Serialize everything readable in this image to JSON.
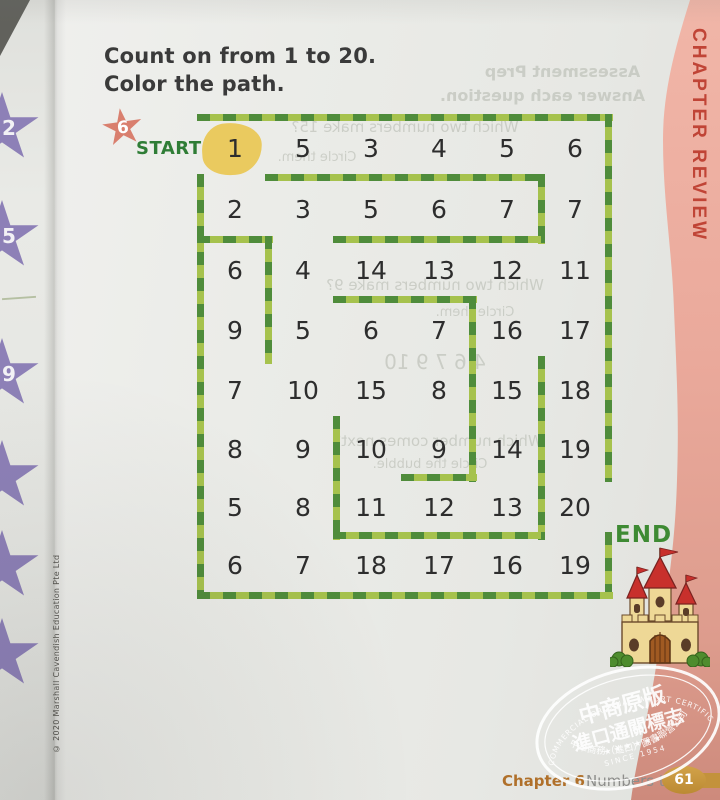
{
  "page": {
    "title_line1": "Count on from 1 to 20.",
    "title_line2": "Color the path.",
    "chapter_tab": "CHAPTER REVIEW",
    "copyright": "© 2020 Marshall Cavendish Education Pte Ltd",
    "footer": {
      "chapter": "Chapter 6",
      "section": "Numbers to 20",
      "page_number": "61"
    }
  },
  "maze": {
    "start_badge": "6",
    "start_label": "START",
    "end_label": "END",
    "grid": [
      [
        "1",
        "5",
        "3",
        "4",
        "5",
        "6"
      ],
      [
        "2",
        "3",
        "5",
        "6",
        "7",
        "7"
      ],
      [
        "6",
        "4",
        "14",
        "13",
        "12",
        "11"
      ],
      [
        "9",
        "5",
        "6",
        "7",
        "16",
        "17"
      ],
      [
        "7",
        "10",
        "15",
        "8",
        "15",
        "18"
      ],
      [
        "8",
        "9",
        "10",
        "9",
        "14",
        "19"
      ],
      [
        "5",
        "8",
        "11",
        "12",
        "13",
        "20"
      ],
      [
        "6",
        "7",
        "18",
        "17",
        "16",
        "19"
      ]
    ],
    "solution_path_values": [
      "1",
      "2",
      "3",
      "4",
      "5",
      "6",
      "7",
      "8",
      "9",
      "10",
      "11",
      "12",
      "13",
      "14",
      "15",
      "16",
      "17",
      "18",
      "19",
      "20"
    ],
    "walls": [
      [
        -4,
        -4,
        416,
        7
      ],
      [
        404,
        -4,
        7,
        368
      ],
      [
        404,
        414,
        7,
        67
      ],
      [
        -4,
        474,
        416,
        7
      ],
      [
        -4,
        56,
        7,
        425
      ],
      [
        64,
        56,
        280,
        7
      ],
      [
        337,
        56,
        7,
        70
      ],
      [
        -4,
        118,
        76,
        7
      ],
      [
        64,
        118,
        7,
        128
      ],
      [
        132,
        118,
        212,
        7
      ],
      [
        132,
        178,
        144,
        7
      ],
      [
        268,
        178,
        7,
        186
      ],
      [
        337,
        238,
        7,
        184
      ],
      [
        200,
        356,
        76,
        7
      ],
      [
        132,
        298,
        7,
        124
      ],
      [
        132,
        414,
        212,
        7
      ]
    ]
  },
  "left_strip": {
    "stars": [
      {
        "value": "2",
        "y": 92
      },
      {
        "value": "5",
        "y": 200
      },
      {
        "value": "9",
        "y": 338
      },
      {
        "value": "",
        "y": 440
      },
      {
        "value": "",
        "y": 530
      },
      {
        "value": "",
        "y": 618
      }
    ]
  },
  "ghost_texts": [
    {
      "text": "Assessment Prep",
      "x": 455,
      "y": 62,
      "w": 215,
      "size": 16,
      "bold": true
    },
    {
      "text": "Answer each question.",
      "x": 415,
      "y": 86,
      "w": 255,
      "size": 16,
      "bold": true
    },
    {
      "text": "Which two numbers make 15?",
      "x": 240,
      "y": 118,
      "w": 330,
      "size": 15,
      "bold": false
    },
    {
      "text": "Circle them.",
      "x": 262,
      "y": 150,
      "w": 110,
      "size": 13,
      "bold": false
    },
    {
      "text": "Which two numbers make 9?",
      "x": 290,
      "y": 276,
      "w": 290,
      "size": 15,
      "bold": false
    },
    {
      "text": "Circle them.",
      "x": 420,
      "y": 305,
      "w": 110,
      "size": 13,
      "bold": false
    },
    {
      "text": "4    6    7    9    10",
      "x": 300,
      "y": 350,
      "w": 270,
      "size": 20,
      "bold": false
    },
    {
      "text": "Which number comes next?",
      "x": 288,
      "y": 432,
      "w": 300,
      "size": 15,
      "bold": false
    },
    {
      "text": "Circle the bubble.",
      "x": 350,
      "y": 457,
      "w": 160,
      "size": 13,
      "bold": false
    }
  ],
  "stamp": {
    "arc_top": "SINO-COMMERCIAL ORIGINAL IMPORT CERTIFICATION",
    "line1": "中商原版",
    "line2": "進口通關標志",
    "stars": "★ ★ ★ ★ ★ ★",
    "since": "SINCE 1954",
    "arc_bottom": "中華商務（進口）圖書聯營公司"
  },
  "colors": {
    "path_dark_green": "#4f8c3b",
    "path_light_green": "#a6c24d",
    "start_green": "#2f7d36",
    "highlight_yellow": "#e9c753",
    "start_star_coral": "#d97f6e",
    "pink_band": "#eaa99b",
    "chapter_red": "#c04436",
    "footer_orange": "#b0702a",
    "page_badge_gold": "#c3923c",
    "edge_star_purple": "#8d80b7"
  }
}
